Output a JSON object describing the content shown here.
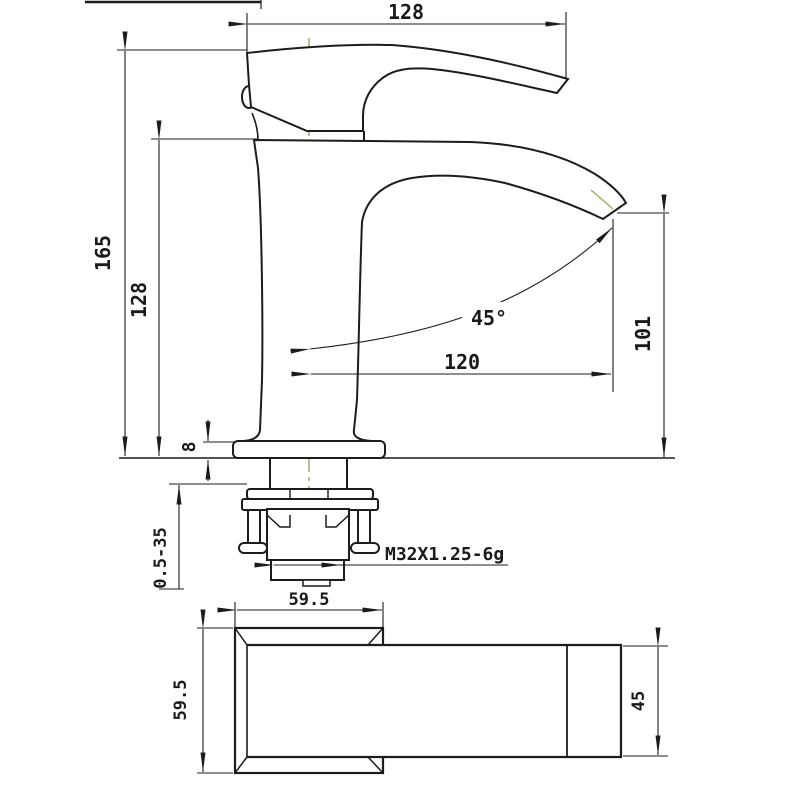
{
  "drawing": {
    "type": "faucet-dimensional-drawing",
    "background": "#ffffff",
    "outline_color": "#1c1c1c",
    "centerline_color": "#8f8f4a",
    "views": {
      "front_view": "single-handle basin faucet side elevation",
      "top_view": "base and handle plan view"
    },
    "dimensions": {
      "handle_top_width": "128",
      "total_height": "165",
      "body_height": "128",
      "spout_outlet_height": "101",
      "spout_reach": "120",
      "spout_angle": "45°",
      "deck_plate_thickness": "8",
      "mounting_thickness_range": "0.5-35",
      "thread_spec": "M32X1.25-6g",
      "base_width": "59.5",
      "base_depth": "59.5",
      "handle_end_width": "45"
    }
  }
}
